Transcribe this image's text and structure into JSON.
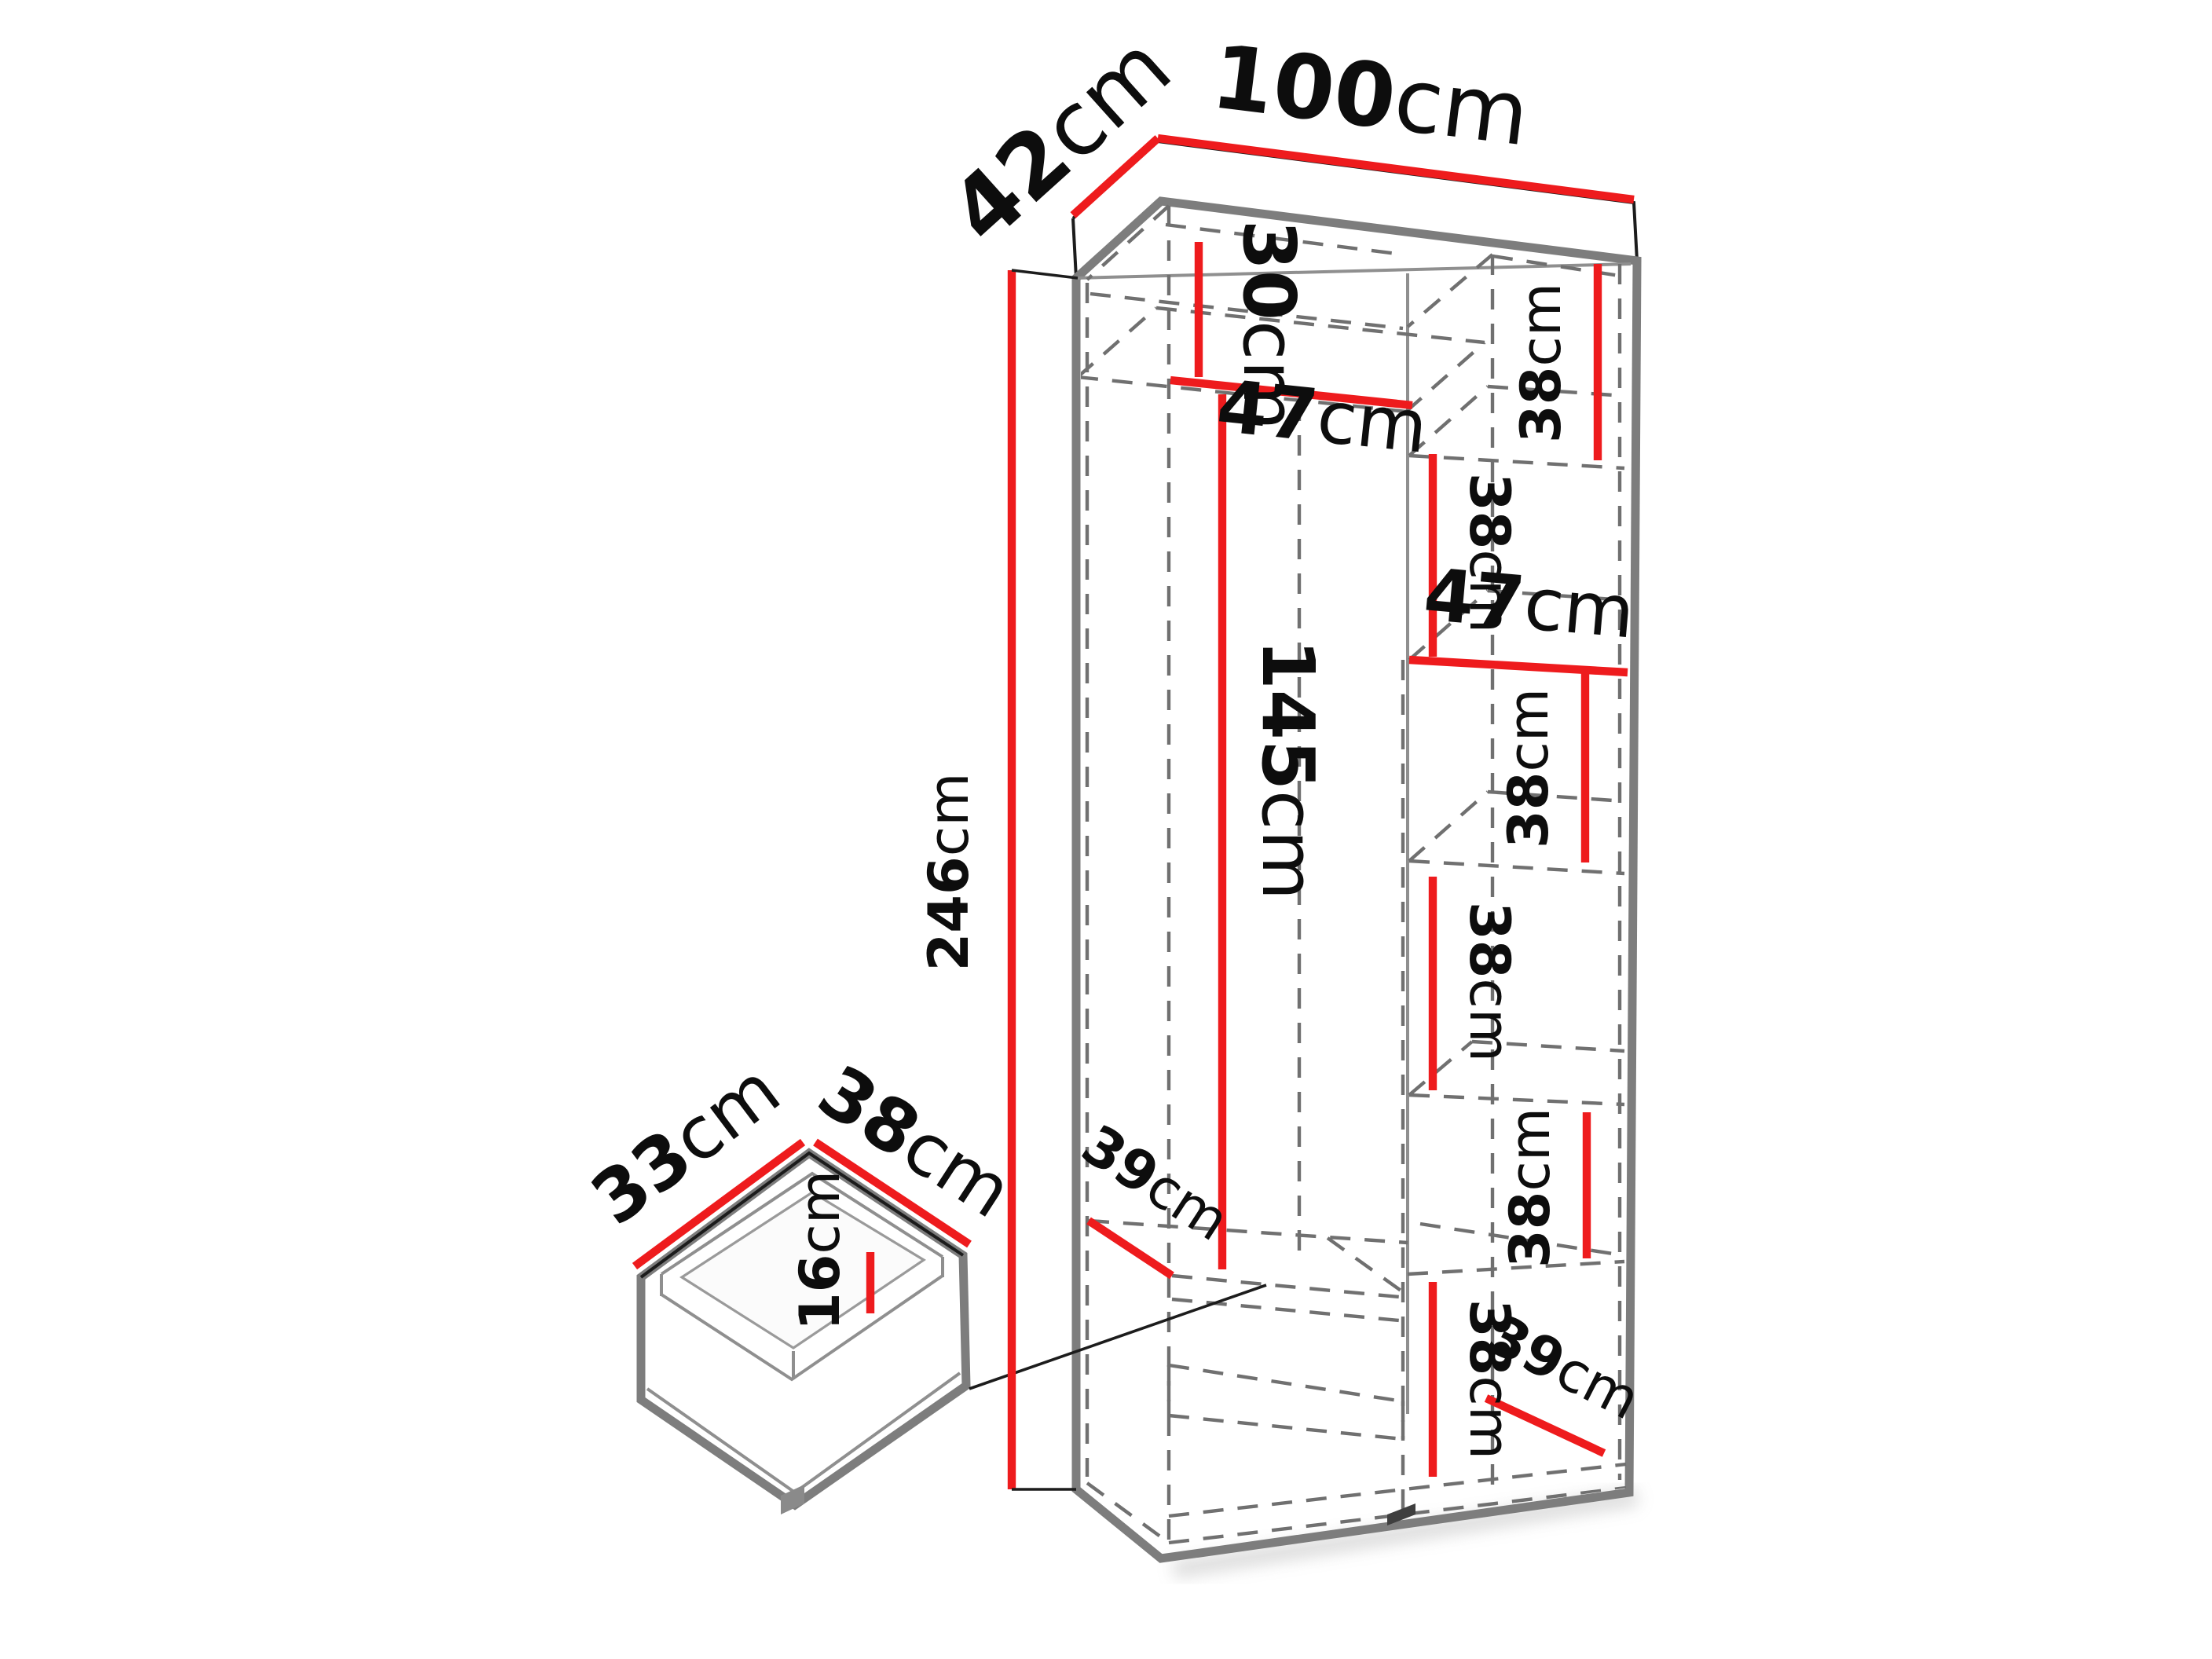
{
  "diagram_type": "furniture-dimension-diagram",
  "product": "tall wardrobe carcass with shelf compartments and internal drawer",
  "colors": {
    "dimension_line": "#ee1b1d",
    "outline_gray": "#7d7d7d",
    "hidden_edge_gray": "#707070",
    "label_text": "#0d0d0d",
    "background": "#ffffff"
  },
  "wardrobe": {
    "overall_width": {
      "value": "100",
      "unit": "cm"
    },
    "overall_depth": {
      "value": "42",
      "unit": "cm"
    },
    "overall_height": {
      "value": "246",
      "unit": "cm"
    },
    "left_section": {
      "top_compartment_height": {
        "value": "30",
        "unit": "cm"
      },
      "interior_width": {
        "value": "47",
        "unit": "cm"
      },
      "hanging_space_height": {
        "value": "145",
        "unit": "cm"
      },
      "shelf_depth": {
        "value": "39",
        "unit": "cm"
      }
    },
    "right_section": {
      "interior_width": {
        "value": "47",
        "unit": "cm"
      },
      "compartment_heights": [
        {
          "value": "38",
          "unit": "cm"
        },
        {
          "value": "38",
          "unit": "cm"
        },
        {
          "value": "38",
          "unit": "cm"
        },
        {
          "value": "38",
          "unit": "cm"
        },
        {
          "value": "38",
          "unit": "cm"
        },
        {
          "value": "38",
          "unit": "cm"
        }
      ],
      "bottom_shelf_depth": {
        "value": "39",
        "unit": "cm"
      }
    }
  },
  "drawer": {
    "inner_depth": {
      "value": "33",
      "unit": "cm"
    },
    "inner_width": {
      "value": "38",
      "unit": "cm"
    },
    "inner_height": {
      "value": "16",
      "unit": "cm"
    }
  }
}
